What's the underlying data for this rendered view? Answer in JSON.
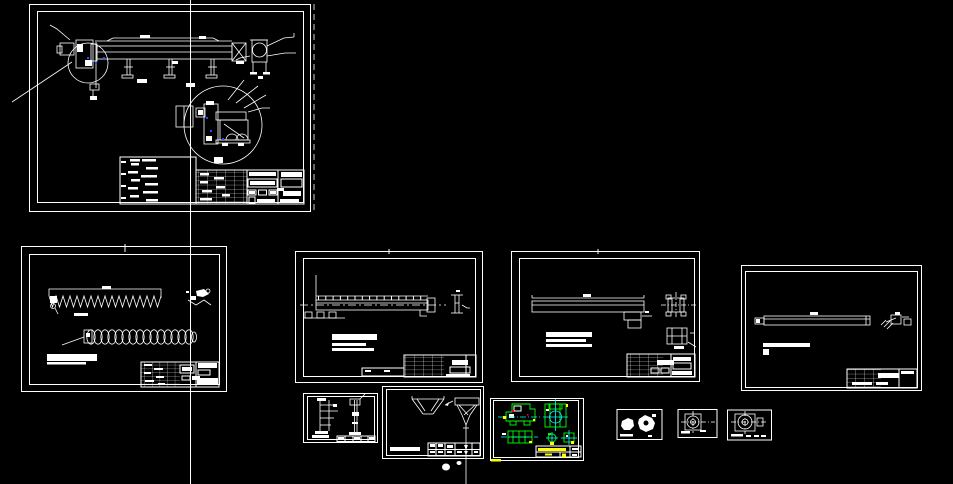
{
  "app": {
    "name": "CAD model space - screw conveyor drawing set",
    "background": "#000000"
  },
  "palette": {
    "background": "#000000",
    "white": "#FFFFFF",
    "green": "#00FF00",
    "cyan": "#00FFFF",
    "yellow": "#FFFF00",
    "red": "#FF0000",
    "grip_blue": "#2050FF"
  },
  "cursor": {
    "type": "vertical-crosshair-line",
    "x": 190
  },
  "sheets": [
    {
      "id": "sheet-assembly",
      "label": "assembly sheet with side view, end view, detail circle, parts list and title block"
    },
    {
      "id": "sheet-screw",
      "label": "screw flight section and helix coil sheet"
    },
    {
      "id": "sheet-trough",
      "label": "trough beam sheet with end section"
    },
    {
      "id": "sheet-cover",
      "label": "cover beam sheet with two small details"
    },
    {
      "id": "sheet-shaft",
      "label": "long shaft sheet with hatched detail"
    },
    {
      "id": "sheet-supports",
      "label": "small support-leg details sheet"
    },
    {
      "id": "sheet-hopper",
      "label": "hopper / funnel sheet with discharge stem"
    },
    {
      "id": "sheet-bearing-color",
      "label": "bearing housing sheet drawn in colored layers"
    },
    {
      "id": "sheet-small-parts",
      "label": "tiny sheet with two gear-like parts"
    },
    {
      "id": "sheet-flange-1",
      "label": "tiny flange sheet with centerlines"
    },
    {
      "id": "sheet-flange-2",
      "label": "tiny flange sheet with centerlines"
    }
  ]
}
